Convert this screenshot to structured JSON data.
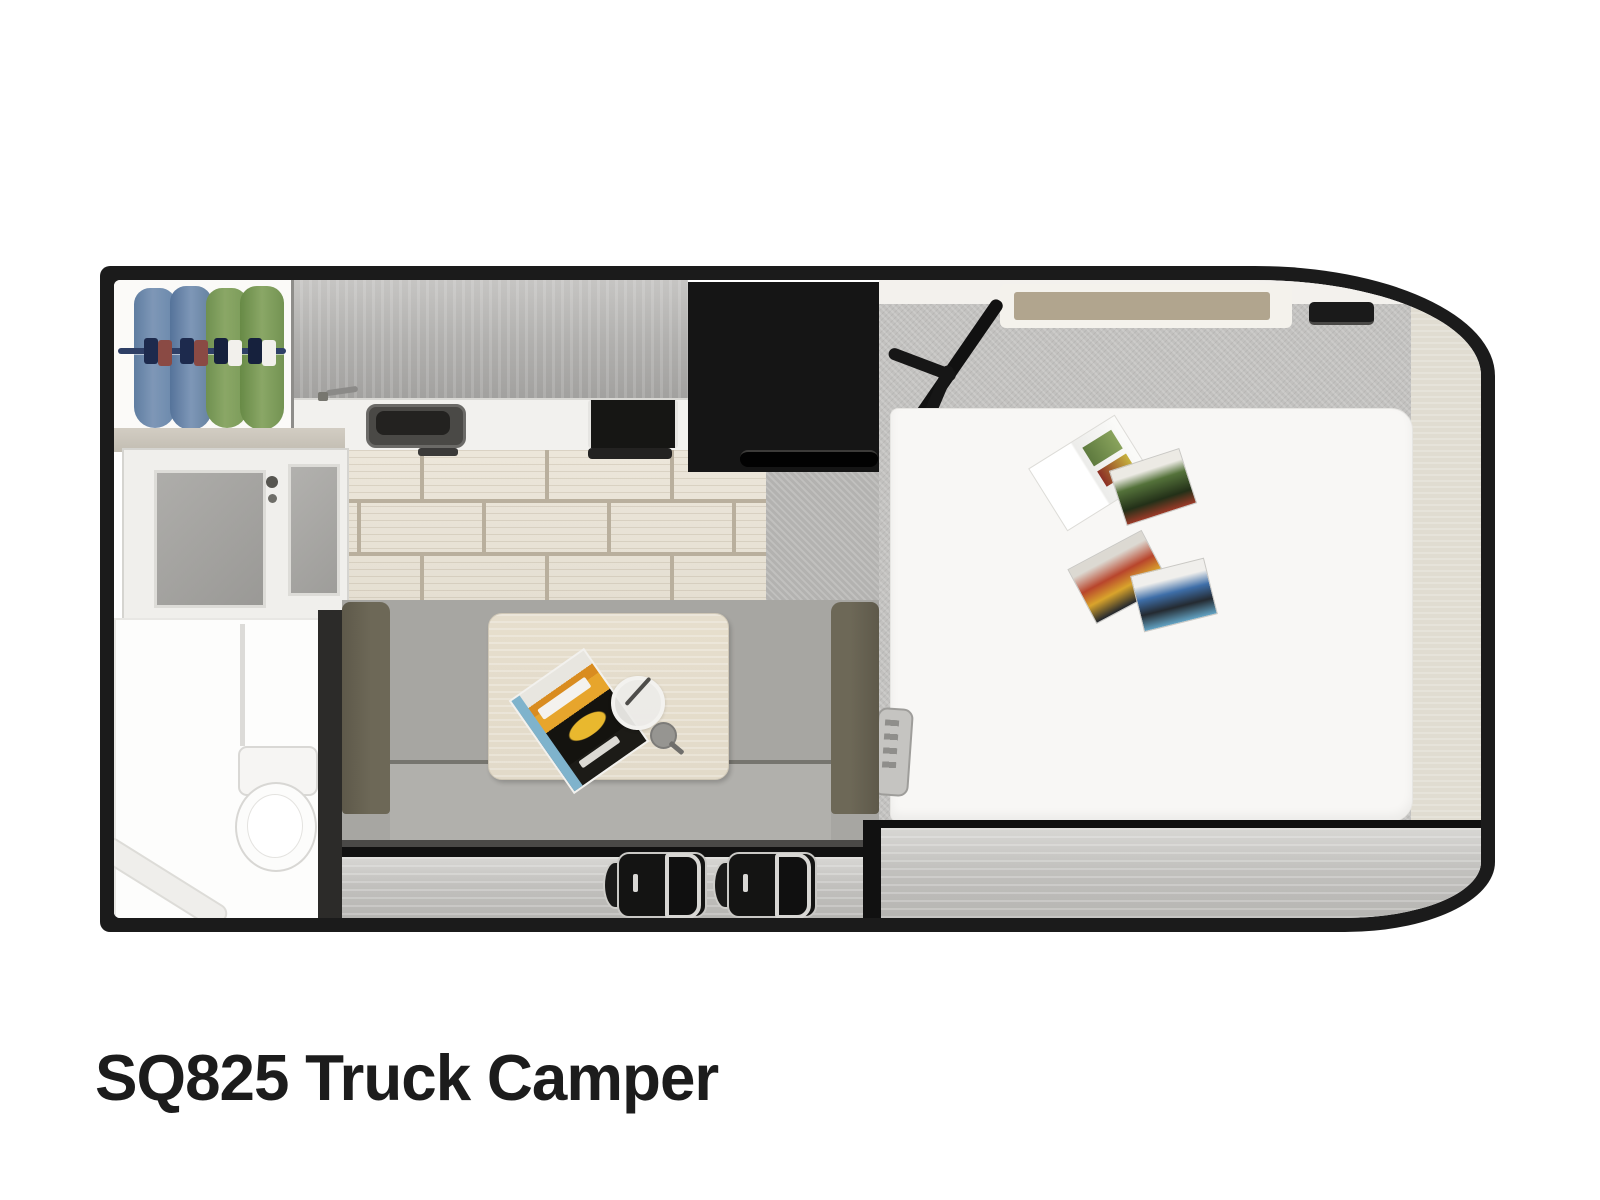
{
  "title": "SQ825 Truck Camper",
  "floorplan": {
    "model": "SQ825",
    "unit_type": "Truck Camper",
    "view": "top-down 3D floor plan",
    "features": [
      "wardrobe-with-hanging-clothes",
      "overhead-cabinet",
      "kitchen-counter-with-sink-and-cooktop",
      "refrigerator",
      "entry-door-with-window",
      "wet-bath-with-toilet-and-shower",
      "sofa-dinette-with-table",
      "cabover-bed-with-mattress",
      "tv-on-swivel-arm",
      "headboard-shelf",
      "two-travel-seats"
    ]
  },
  "palette": {
    "wall": "#1b1b1b",
    "grout": "#b9af9d",
    "fridge": "#151515",
    "mattress": "#f8f7f5",
    "sofa": "#a7a6a2",
    "sofa-dark": "#6d6857",
    "table": "#e2dac9",
    "bath": "#fdfdfc",
    "jacket-blue": "#7e97b7",
    "jacket-green": "#8aa766",
    "shelf-tan": "#b1a58e",
    "title": "#1c1c1c"
  }
}
